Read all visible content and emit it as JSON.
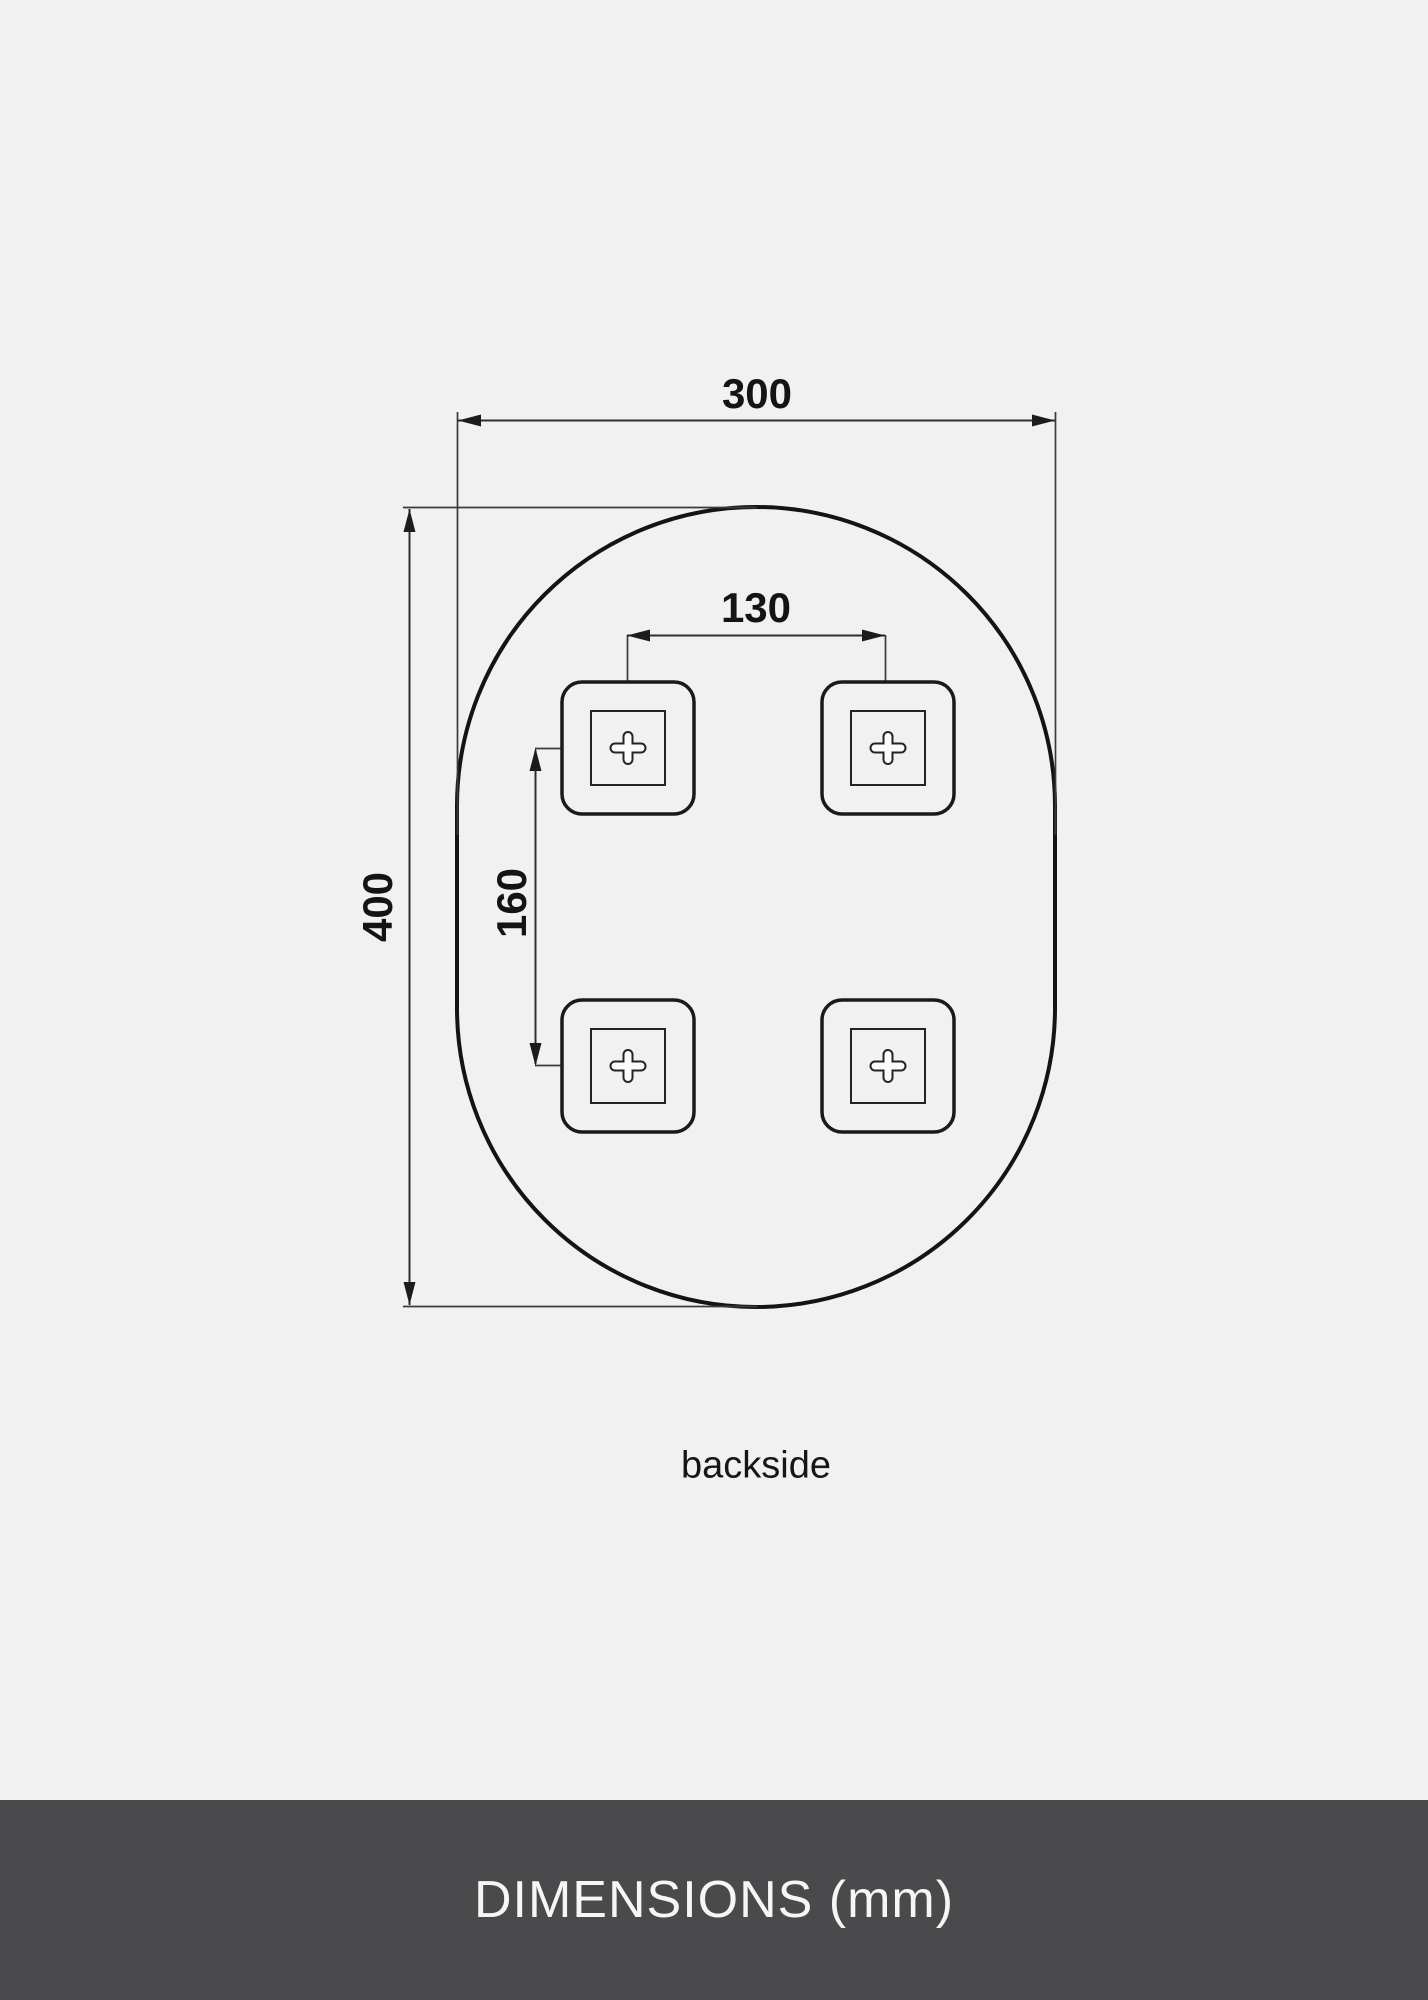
{
  "page": {
    "background_color": "#f1f1f2"
  },
  "drawing": {
    "view_caption": "backside",
    "dimensions": {
      "overall_width_mm": "300",
      "overall_height_mm": "400",
      "bracket_spacing_horizontal_mm": "130",
      "bracket_spacing_vertical_mm": "160"
    },
    "line_color": "#1a1a1a"
  },
  "footer": {
    "title": "DIMENSIONS (mm)",
    "background_color": "#4a4a4c",
    "text_color": "#f6f6f6"
  }
}
